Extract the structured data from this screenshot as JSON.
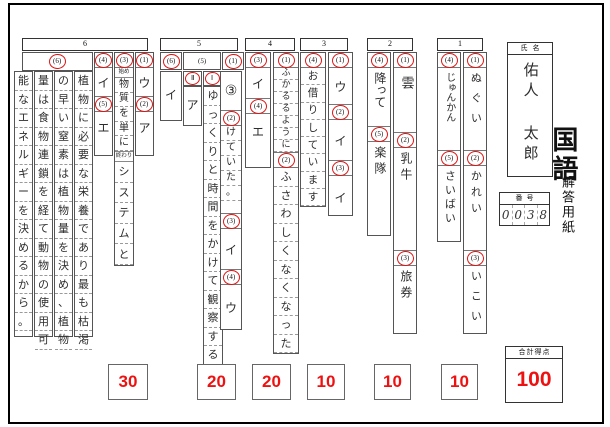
{
  "meta": {
    "subject": "国語",
    "sheet_title": "解答用紙",
    "accent_red": "#ee1111",
    "circle_red": "#e11414"
  },
  "student": {
    "name_label": "氏名",
    "name": "佑人 太郎",
    "number_label": "番号",
    "number_digits": [
      "0",
      "0",
      "3",
      "8"
    ]
  },
  "sections": {
    "s6": {
      "header": "6",
      "q6": {
        "num": "(6)",
        "lines": [
          "植物に必要な栄養であり最も枯渇",
          "の早い窒素は植物量を決め、植物",
          "量は食物連鎖を経て動物の使用可",
          "能なエネルギーを決めるから。"
        ]
      },
      "q4": {
        "num": "(4)",
        "answer": "イ"
      },
      "q5": {
        "num": "(5)",
        "answer": "エ"
      },
      "q3": {
        "num": "(3)",
        "start_label": "始め",
        "start_answer": "物質を単に",
        "end_label": "終わり",
        "end_answer": "システムと"
      },
      "q1": {
        "num": "(1)",
        "answer": "ウ"
      },
      "q2": {
        "num": "(2)",
        "answer": "ア"
      }
    },
    "s5": {
      "header": "5",
      "q6": {
        "num": "(6)",
        "answer": "イ"
      },
      "q5": {
        "num": "(5)",
        "sub2_label": "Ⅱ",
        "sub2_answer": "ア",
        "sub1_label": "Ⅰ",
        "sub1_answer": "ゆっくりと時間をかけて観察する"
      },
      "q1": {
        "num": "(1)",
        "answer": "③"
      },
      "q2": {
        "num": "(2)",
        "answer": "けていた。"
      },
      "q3": {
        "num": "(3)",
        "answer": "イ"
      },
      "q4": {
        "num": "(4)",
        "answer": "ウ"
      }
    },
    "s4": {
      "header": "4",
      "q3": {
        "num": "(3)",
        "answer": "イ"
      },
      "q4": {
        "num": "(4)",
        "answer": "エ"
      },
      "q1": {
        "num": "(1)",
        "answer": "ふかるるように"
      },
      "q2": {
        "num": "(2)",
        "answer": "ふさわしくなくなった"
      }
    },
    "s3": {
      "header": "3",
      "q4": {
        "num": "(4)",
        "answer": "お借りしています"
      },
      "q1": {
        "num": "(1)",
        "answer": "ウ"
      },
      "q2": {
        "num": "(2)",
        "answer": "イ"
      },
      "q3": {
        "num": "(3)",
        "answer": "イ"
      }
    },
    "s2": {
      "header": "2",
      "q4": {
        "num": "(4)",
        "answer": "降って"
      },
      "q5": {
        "num": "(5)",
        "answer": "楽隊"
      },
      "q1": {
        "num": "(1)",
        "answer": "雲"
      },
      "q2": {
        "num": "(2)",
        "answer": "乳牛"
      },
      "q3": {
        "num": "(3)",
        "answer": "旅券"
      }
    },
    "s1": {
      "header": "1",
      "q4": {
        "num": "(4)",
        "answer": "じゅんかん"
      },
      "q5": {
        "num": "(5)",
        "answer": "さいばい"
      },
      "q1": {
        "num": "(1)",
        "answer": "ぬぐい"
      },
      "q2": {
        "num": "(2)",
        "answer": "かれい"
      },
      "q3": {
        "num": "(3)",
        "answer": "いこい"
      }
    }
  },
  "scores": {
    "per_section": [
      "30",
      "20",
      "20",
      "10",
      "10",
      "10"
    ],
    "total_label": "合計得点",
    "total": "100"
  }
}
